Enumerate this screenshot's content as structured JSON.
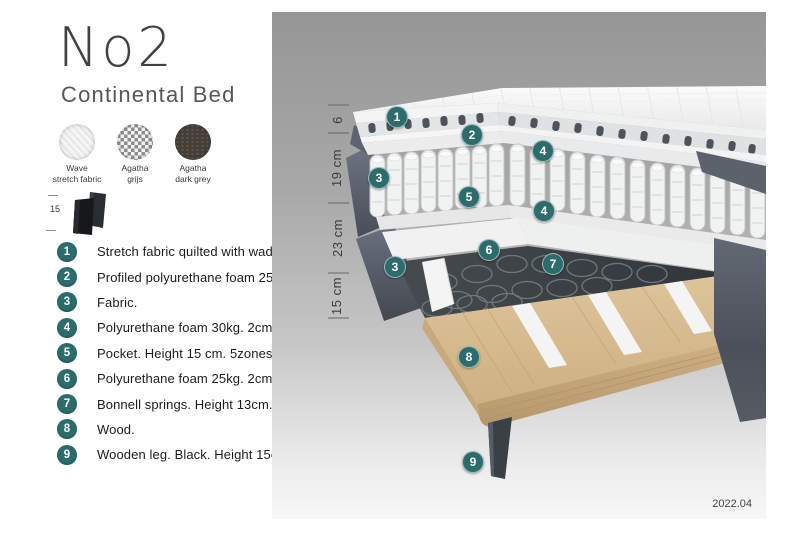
{
  "header": {
    "title": "No2",
    "subtitle": "Continental Bed"
  },
  "swatches": [
    {
      "line1": "Wave",
      "line2": "stretch fabric"
    },
    {
      "line1": "Agatha",
      "line2": "grijs"
    },
    {
      "line1": "Agatha",
      "line2": "dark grey"
    }
  ],
  "leg_detail": {
    "height": "15"
  },
  "legend": [
    {
      "num": "1",
      "text": "Stretch fabric quilted with wadding."
    },
    {
      "num": "2",
      "text": "Profiled polyurethane foam 25kg. 4cm."
    },
    {
      "num": "3",
      "text": "Fabric."
    },
    {
      "num": "4",
      "text": "Polyurethane foam 30kg. 2cm."
    },
    {
      "num": "5",
      "text": "Pocket. Height 15 cm. 5zones."
    },
    {
      "num": "6",
      "text": "Polyurethane foam 25kg. 2cm."
    },
    {
      "num": "7",
      "text": "Bonnell springs. Height 13cm."
    },
    {
      "num": "8",
      "text": "Wood."
    },
    {
      "num": "9",
      "text": "Wooden leg. Black. Height 15cm."
    }
  ],
  "diagram": {
    "measurements": [
      {
        "label": "6"
      },
      {
        "label": "19 cm"
      },
      {
        "label": "23 cm"
      },
      {
        "label": "15 cm"
      }
    ],
    "markers": [
      {
        "label": "1"
      },
      {
        "label": "2"
      },
      {
        "label": "4"
      },
      {
        "label": "3"
      },
      {
        "label": "5"
      },
      {
        "label": "4"
      },
      {
        "label": "6"
      },
      {
        "label": "7"
      },
      {
        "label": "3"
      },
      {
        "label": "8"
      },
      {
        "label": "9"
      }
    ],
    "version": "2022.04"
  },
  "colors": {
    "accent_teal": "#2c6c6c",
    "fabric_dark": "#555b68",
    "wood": "#d6ba8e",
    "leg_black": "#3b3f46"
  }
}
